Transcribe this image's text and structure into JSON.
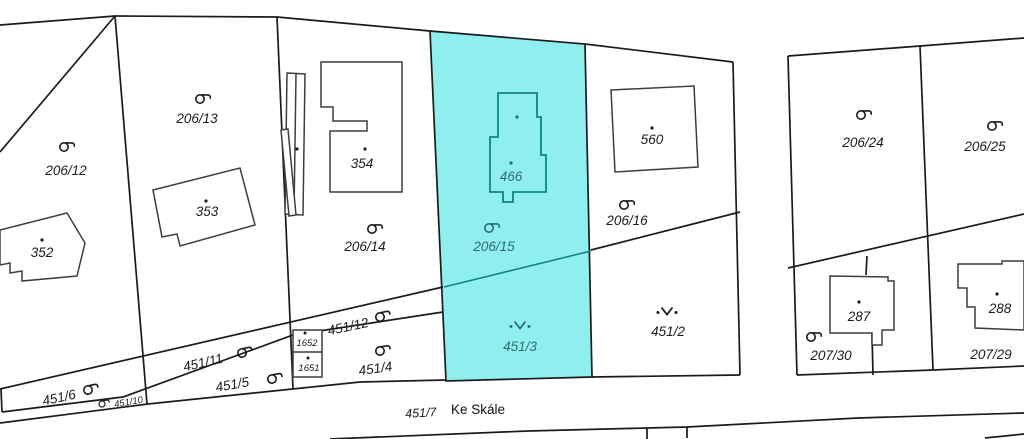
{
  "map": {
    "street": {
      "label": "Ke Skále"
    },
    "highlighted_parcels": [
      "206/15",
      "451/3"
    ],
    "colors": {
      "background": "#ffffff",
      "boundary_line": "#1b1b1b",
      "building_line": "#3d3d3d",
      "highlight_fill": "#8FEFEF",
      "highlight_stroke": "#0E8484",
      "highlight_text": "#2F6D6D",
      "label_text": "#1b1b1b"
    },
    "parcels": [
      {
        "label": "206/12",
        "land_use": "garden"
      },
      {
        "label": "206/13",
        "land_use": "garden"
      },
      {
        "label": "206/14",
        "land_use": "garden"
      },
      {
        "label": "206/15",
        "land_use": "garden",
        "highlighted": true
      },
      {
        "label": "206/16",
        "land_use": "garden"
      },
      {
        "label": "206/24",
        "land_use": "garden"
      },
      {
        "label": "206/25",
        "land_use": "garden"
      },
      {
        "label": "207/30",
        "land_use": "garden"
      },
      {
        "label": "207/29",
        "land_use": ""
      },
      {
        "label": "451/2",
        "land_use": "grassland"
      },
      {
        "label": "451/3",
        "land_use": "grassland",
        "highlighted": true
      },
      {
        "label": "451/12",
        "land_use": "garden"
      },
      {
        "label": "451/4",
        "land_use": "garden"
      },
      {
        "label": "451/11",
        "land_use": "garden"
      },
      {
        "label": "451/5",
        "land_use": "garden"
      },
      {
        "label": "451/6",
        "land_use": "garden"
      },
      {
        "label": "451/10",
        "land_use": "garden"
      },
      {
        "label": "451/7",
        "land_use": ""
      }
    ],
    "buildings": [
      {
        "label": "352"
      },
      {
        "label": "353"
      },
      {
        "label": "354"
      },
      {
        "label": "466",
        "highlighted": true
      },
      {
        "label": "560"
      },
      {
        "label": "287"
      },
      {
        "label": "288"
      },
      {
        "label": "1652"
      },
      {
        "label": "1651"
      }
    ]
  }
}
